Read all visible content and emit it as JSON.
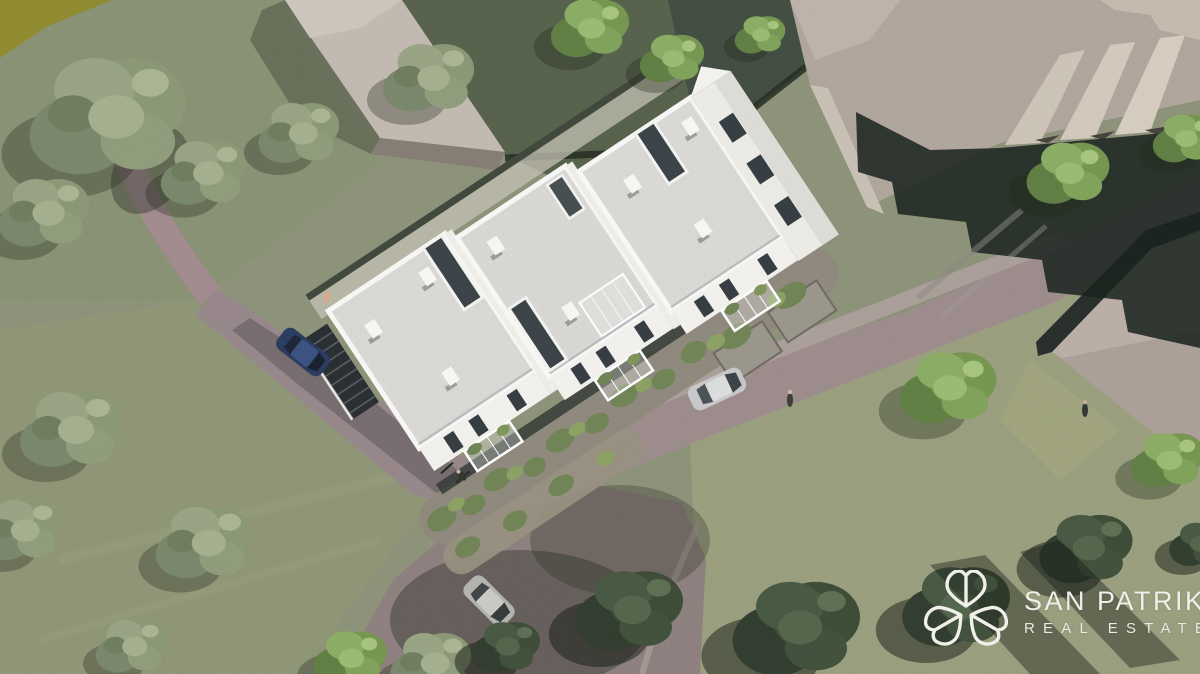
{
  "watermark": {
    "brand": "SAN PATRIK",
    "tagline": "REAL ESTATE",
    "icon": "shamrock-logo-icon",
    "text_color": "#F0EFEA"
  },
  "scene": {
    "description": "Aerial 3D architectural rendering of a modern white multi-unit residential building with flat gray tiled roofs, rooftop terraces, planted balconies and stone retaining walls, surrounded by lawns, trees, access roads, parked cars, a cyclist, pedestrians and gray neighboring massing buildings.",
    "objects": [
      "white-apartment-building",
      "flat-gray-roofs",
      "roof-terraces",
      "balconies-with-plants",
      "stone-retaining-walls",
      "planted-garden-beds",
      "access-road",
      "footpath",
      "outdoor-stairs",
      "parked-blue-car",
      "parked-silver-car",
      "driving-silver-car",
      "cyclist",
      "pedestrian",
      "neighboring-buildings",
      "hedged-back-garden",
      "trees",
      "lawn"
    ],
    "palette": {
      "grass": "#8C9278",
      "grass_light": "#9AA07E",
      "road": "#9C8B8B",
      "path": "#A18A8E",
      "building_white": "#F2F1ED",
      "roof_gray": "#D9D8D4",
      "window_dark": "#343B40",
      "context_building": "#B5ABA1",
      "shadow_dark": "#16201B",
      "tree_sage": "#8A9775",
      "tree_bright": "#74954F",
      "tree_dark": "#3B4A35",
      "car_blue": "#283A5F",
      "car_silver": "#C4C6C7",
      "logo_white": "#F0EFEA"
    }
  }
}
